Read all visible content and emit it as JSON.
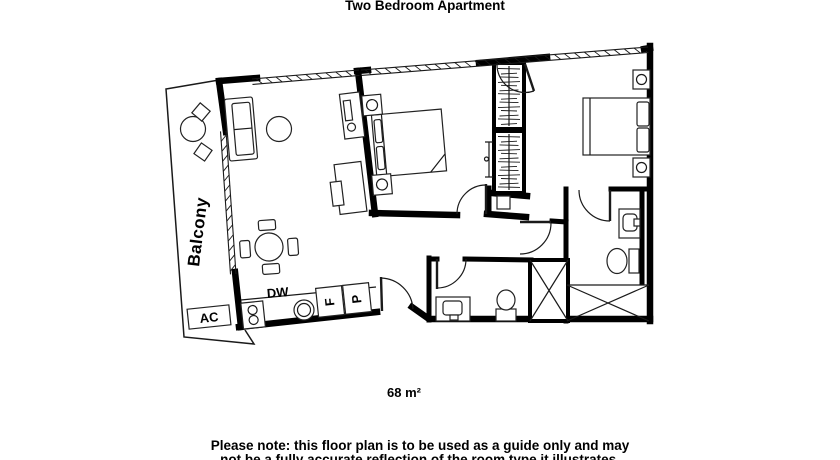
{
  "title": "Two Bedroom Apartment",
  "plan": {
    "balcony_label": "Balcony",
    "ac_label": "AC",
    "dw_label": "DW",
    "fridge_label": "F",
    "pantry_label": "P",
    "area_label": "68 m²"
  },
  "footer": {
    "note_line1": "Please note: this floor plan is to be used as a guide only and may",
    "note_line2": "not be a fully accurate reflection of the room type it illustrates."
  },
  "colors": {
    "ink": "#000000",
    "background": "#ffffff"
  }
}
